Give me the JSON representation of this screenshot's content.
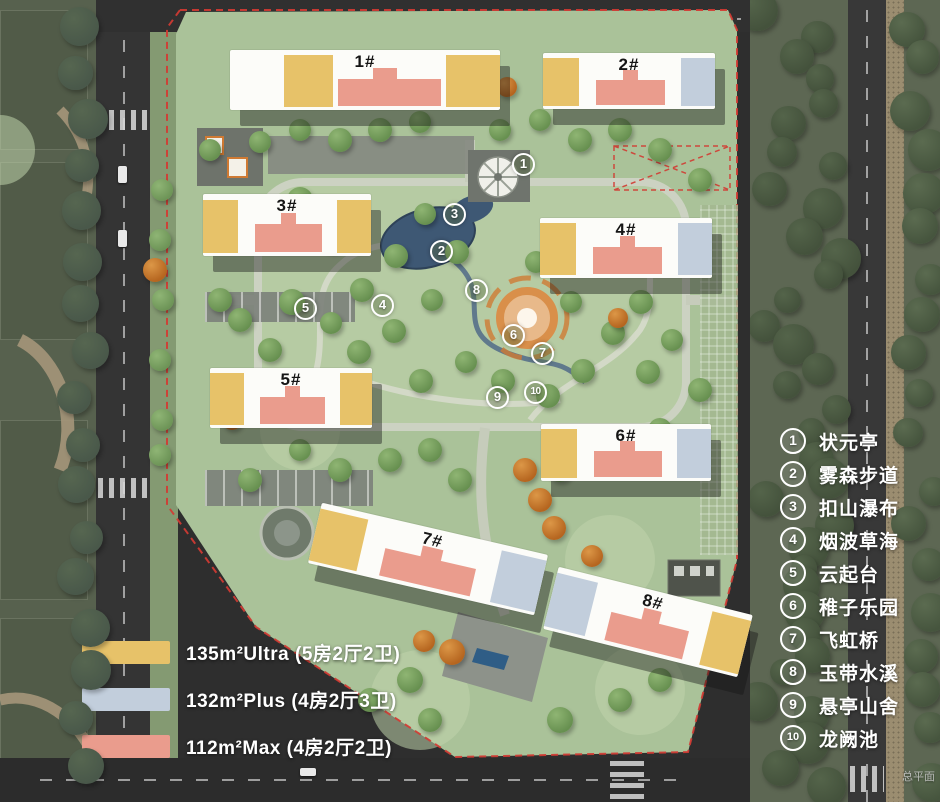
{
  "corner_label": "总平面",
  "map": {
    "buildings": [
      {
        "label": "1#"
      },
      {
        "label": "2#"
      },
      {
        "label": "3#"
      },
      {
        "label": "4#"
      },
      {
        "label": "5#"
      },
      {
        "label": "6#"
      },
      {
        "label": "7#"
      },
      {
        "label": "8#"
      }
    ],
    "markers": [
      {
        "num": "1",
        "x": 524,
        "y": 165
      },
      {
        "num": "2",
        "x": 442,
        "y": 252
      },
      {
        "num": "3",
        "x": 455,
        "y": 215
      },
      {
        "num": "4",
        "x": 383,
        "y": 306
      },
      {
        "num": "5",
        "x": 306,
        "y": 309
      },
      {
        "num": "6",
        "x": 514,
        "y": 336
      },
      {
        "num": "7",
        "x": 543,
        "y": 354
      },
      {
        "num": "8",
        "x": 477,
        "y": 291
      },
      {
        "num": "9",
        "x": 498,
        "y": 398
      },
      {
        "num": "10",
        "x": 536,
        "y": 393
      }
    ]
  },
  "poi_legend": {
    "items": [
      {
        "num": "1",
        "label": "状元亭"
      },
      {
        "num": "2",
        "label": "雾森步道"
      },
      {
        "num": "3",
        "label": "扣山瀑布"
      },
      {
        "num": "4",
        "label": "烟波草海"
      },
      {
        "num": "5",
        "label": "云起台"
      },
      {
        "num": "6",
        "label": "稚子乐园"
      },
      {
        "num": "7",
        "label": "飞虹桥"
      },
      {
        "num": "8",
        "label": "玉带水溪"
      },
      {
        "num": "9",
        "label": "悬亭山舍"
      },
      {
        "num": "10",
        "label": "龙阙池"
      }
    ]
  },
  "unit_legend": {
    "items": [
      {
        "color": "#e7c269",
        "label": "135m²Ultra (5房2厅2卫)"
      },
      {
        "color": "#c2cedc",
        "label": "132m²Plus (4房2厅3卫)"
      },
      {
        "color": "#ea9c8d",
        "label": "112m²Max (4房2厅2卫)"
      }
    ]
  }
}
